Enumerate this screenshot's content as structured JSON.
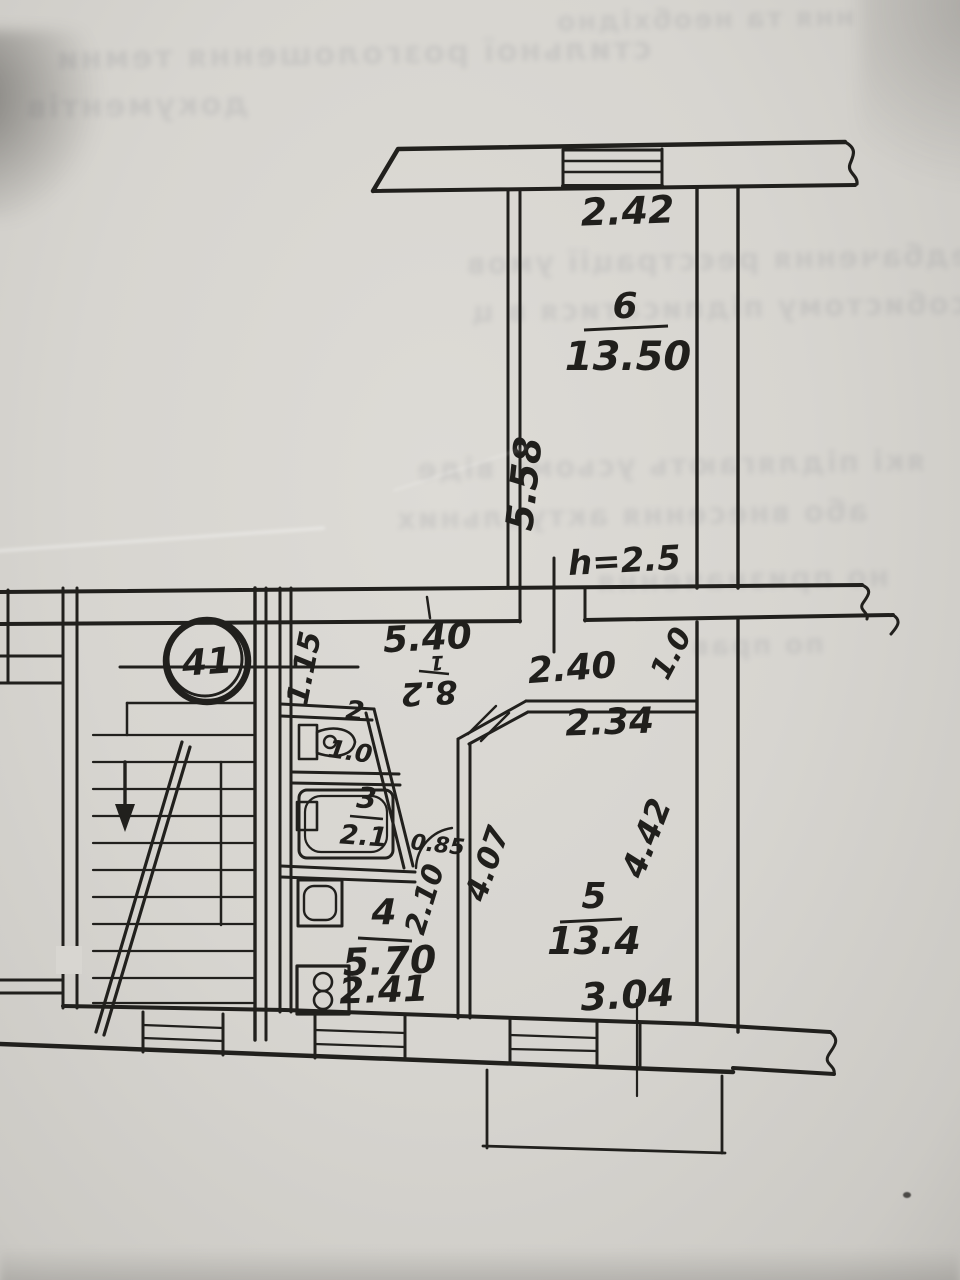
{
  "document": {
    "type": "scanned hand-drawn apartment floor plan",
    "apartment_number": "41"
  },
  "plan": {
    "apartment_circle_number": "41",
    "rooms": {
      "corridor": {
        "number": "1",
        "area": "8.2"
      },
      "wc": {
        "number": "2",
        "area": "1.0"
      },
      "bathroom": {
        "number": "3",
        "area": "2.1"
      },
      "kitchen": {
        "number": "4",
        "area": "5.70"
      },
      "living_room": {
        "number": "5",
        "area": "13.4"
      },
      "bedroom": {
        "number": "6",
        "area": "13.50"
      }
    },
    "dimensions": {
      "room6_width": "2.42",
      "room6_depth": "5.58",
      "ceiling_height": "h=2.5",
      "corridor_length": "5.40",
      "corridor_width": "1.15",
      "room5_wall_top": "2.40",
      "room5_width_upper": "2.34",
      "room5_door_width": "1.0",
      "passage_width": "0.85",
      "passage_length": "2.10",
      "room5_depth_left": "4.07",
      "room5_depth_right": "4.42",
      "room5_width_bottom": "3.04",
      "kitchen_width": "2.41"
    },
    "colors": {
      "ink": "#21201d",
      "paper": "#d8d6d1"
    }
  },
  "artifacts": {
    "bleed_lines": [
      "ння та необхідно",
      "стильної розголошення темни",
      "документів",
      "передбачення реєстрації умов",
      "по особистому підписатися в ц",
      "які підлягають усьому віде",
      "або внесення актуальних",
      "но призначення",
      "по прав"
    ]
  }
}
